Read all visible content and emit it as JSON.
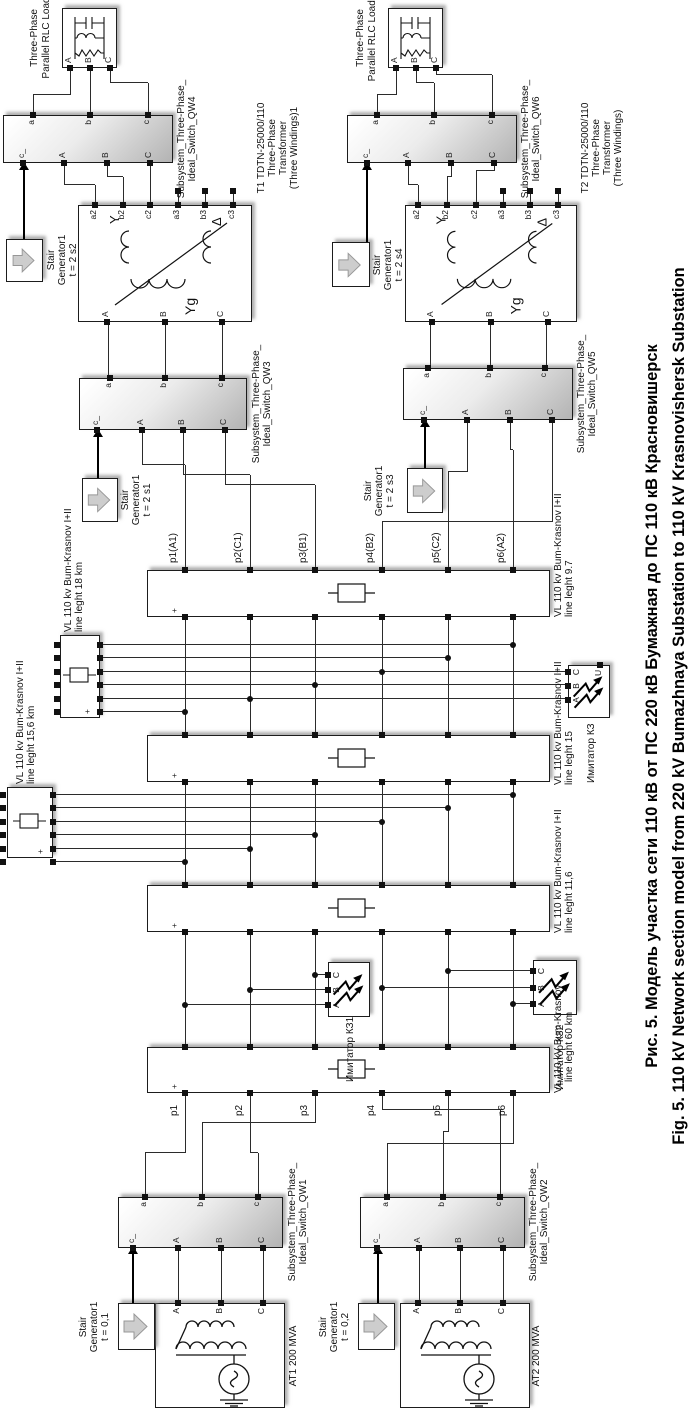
{
  "figure": {
    "caption_ru": "Рис. 5. Модель участка сети 110 кВ от ПС 220 кВ Бумажная до ПС 110 кВ Красновишерск",
    "caption_en": "Fig. 5. 110 kV Network section model from 220 kV Bumazhnaya Substation to 110 kV Krasnovishersk Substation"
  },
  "ports": {
    "a": "a",
    "b": "b",
    "c": "c",
    "cu": "c_",
    "A": "A",
    "B": "B",
    "C": "C",
    "a2": "a2",
    "b2": "b2",
    "c2": "c2",
    "a3": "a3",
    "b3": "b3",
    "c3": "c3",
    "U": "U",
    "plus": "+"
  },
  "sources": {
    "at1": {
      "label": "AT1 200 MVA"
    },
    "at2": {
      "label": "AT2 200 MVA"
    }
  },
  "stair": {
    "line1": "Stair",
    "line2": "Generator1",
    "sg1": {
      "t": "t = 0,1"
    },
    "sg2": {
      "t": "t = 0,2"
    },
    "sg3": {
      "t": "t = 2 s1"
    },
    "sg4": {
      "t": "t = 2 s3"
    },
    "sg5": {
      "t": "t = 2 s2"
    },
    "sg6": {
      "t": "t = 2 s4"
    }
  },
  "switches": {
    "line1": "Subsystem_Three-Phase_",
    "qw1": {
      "line2": "Ideal_Switch_QW1"
    },
    "qw2": {
      "line2": "Ideal_Switch_QW2"
    },
    "qw3": {
      "line2": "Ideal_Switch_QW3"
    },
    "qw4": {
      "line2": "Ideal_Switch_QW4"
    },
    "qw5": {
      "line2": "Ideal_Switch_QW5"
    },
    "qw6": {
      "line2": "Ideal_Switch_QW6"
    }
  },
  "transformers": {
    "t1": {
      "line1": "T1 TDTN-25000/110",
      "line2": "Three-Phase",
      "line3": "Transformer",
      "line4": "(Three Windings)1",
      "yg": "Yg",
      "y": "Y",
      "delta": "Δ"
    },
    "t2": {
      "line1": "T2 TDTN-25000/110",
      "line2": "Three-Phase",
      "line3": "Transformer",
      "line4": "(Three Windings)",
      "yg": "Yg",
      "y": "Y",
      "delta": "Δ"
    }
  },
  "loads": {
    "line1": "Three-Phase",
    "load1": {
      "line2": "Parallel RLC Load"
    },
    "load2": {
      "line2": "Parallel RLC Load1"
    }
  },
  "lines": {
    "l1": {
      "name": "VL 110 kv Bum-Krasnov I+II",
      "len": "line leght 9.7"
    },
    "l2": {
      "name": "VL 110 kv Bum-Krasnov I+II",
      "len": "line leght 15"
    },
    "l3": {
      "name": "VL 110 kv Bum-Krasnov I+II",
      "len": "line leght 11,6"
    },
    "l4": {
      "name": "VL 110 kV Bum-Krasnov",
      "len": "line leght 60 km"
    },
    "s1": {
      "name": "VL 110 kv Bum-Krasnov I+II",
      "len": "line leght 18 km"
    },
    "s2": {
      "name": "VL 110 kv Bum-Krasnov I+II",
      "len": "line leght 15,6 km"
    }
  },
  "faults": {
    "k0": {
      "label": "Имитатор КЗ"
    },
    "k1": {
      "label": "Имитатор КЗ1"
    },
    "k2": {
      "label": "Имитатор КЗ2"
    }
  },
  "bus": {
    "top": [
      "p1(A1)",
      "p2(C1)",
      "p3(B1)",
      "p4(B2)",
      "p5(C2)",
      "p6(A2)"
    ],
    "bottom": [
      "p1",
      "p2",
      "p3",
      "p4",
      "p5",
      "p6"
    ]
  }
}
